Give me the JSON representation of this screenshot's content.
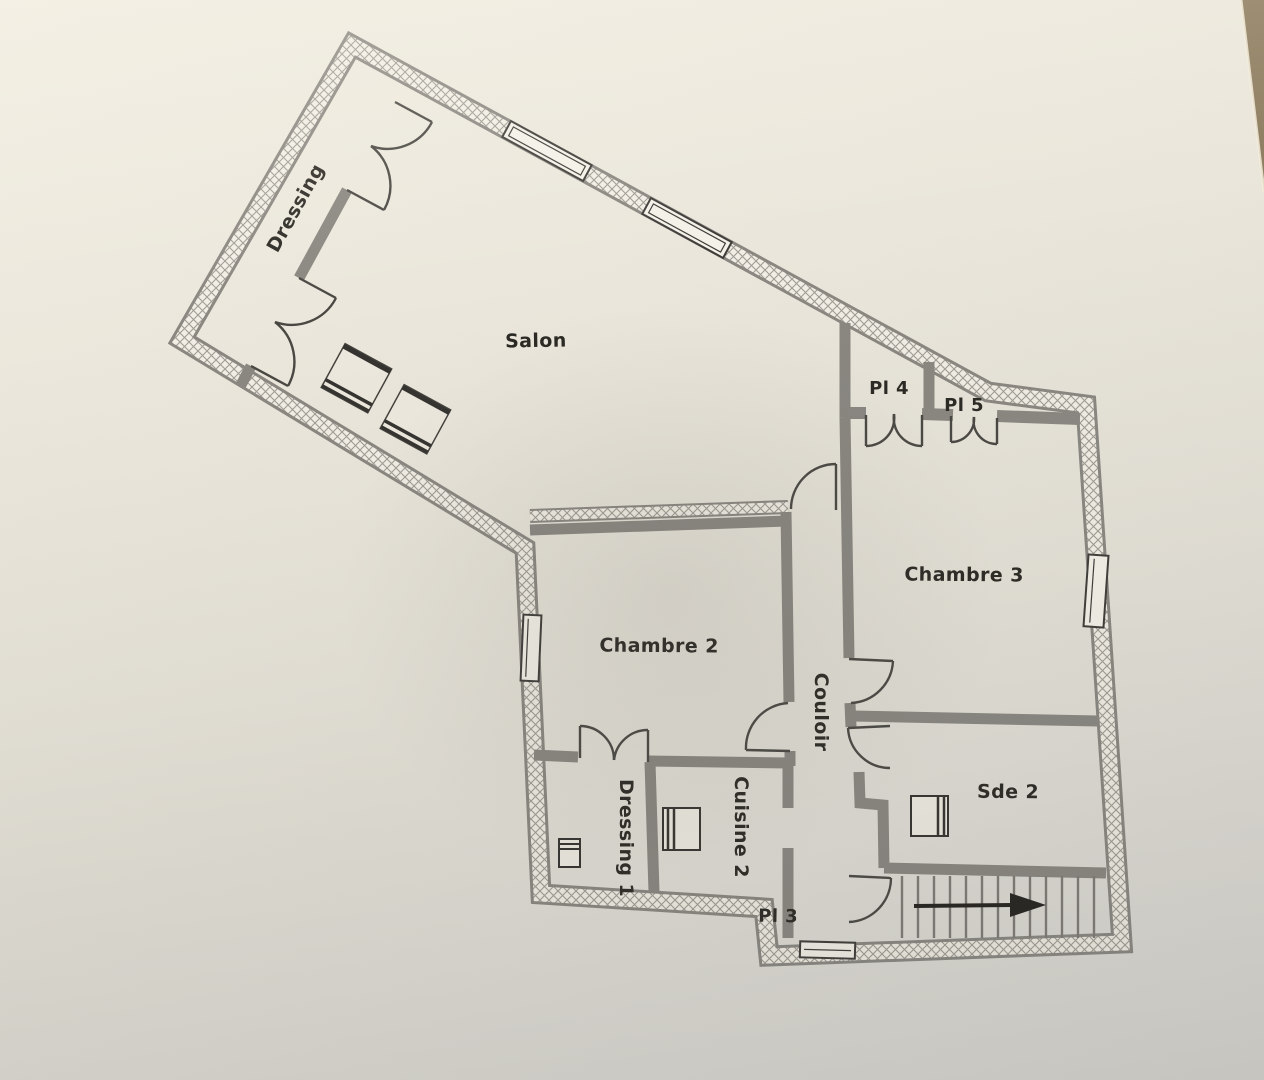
{
  "photo": {
    "paper_color": "#eae6db",
    "table_color": "#8e7d60",
    "description": "photographed floor plan on paper"
  },
  "floor_plan": {
    "rooms": [
      {
        "id": "dressing",
        "label": "Dressing"
      },
      {
        "id": "salon",
        "label": "Salon"
      },
      {
        "id": "pl4",
        "label": "Pl 4"
      },
      {
        "id": "pl5",
        "label": "Pl 5"
      },
      {
        "id": "chambre3",
        "label": "Chambre 3"
      },
      {
        "id": "chambre2",
        "label": "Chambre 2"
      },
      {
        "id": "couloir",
        "label": "Couloir"
      },
      {
        "id": "dressing1",
        "label": "Dressing 1"
      },
      {
        "id": "cuisine2",
        "label": "Cuisine 2"
      },
      {
        "id": "pl3",
        "label": "Pl 3"
      },
      {
        "id": "sde2",
        "label": "Sde 2"
      }
    ],
    "colors": {
      "wall_gray": "#8a8781",
      "hatch_line": "#a09c93",
      "hatch_bg": "#f1eee5",
      "door_line": "#4a4843",
      "text": "#2b2923"
    },
    "stairs": {
      "arrow_direction": "right"
    }
  }
}
